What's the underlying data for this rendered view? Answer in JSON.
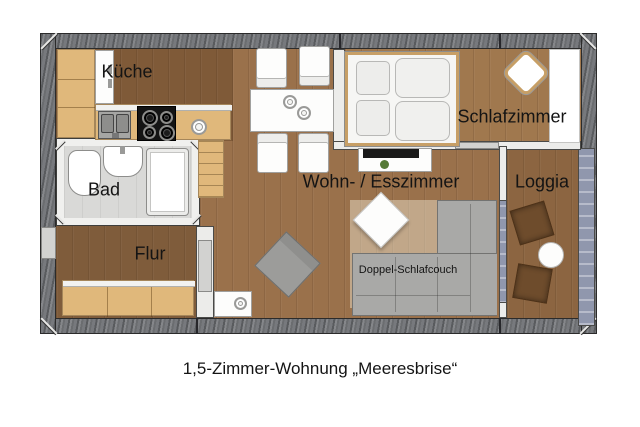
{
  "caption": "1,5-Zimmer-Wohnung „Meeresbrise“",
  "rooms": {
    "kitchen": {
      "label": "Küche"
    },
    "bathroom": {
      "label": "Bad"
    },
    "hallway": {
      "label": "Flur"
    },
    "living": {
      "label": "Wohn- / Esszimmer"
    },
    "bedroom": {
      "label": "Schlafzimmer"
    },
    "loggia": {
      "label": "Loggia"
    }
  },
  "furniture": {
    "sofa_label": "Doppel-Schlafcouch"
  },
  "palette": {
    "exterior_wall": "#77797d",
    "wood_floor_living": "#9a714b",
    "wood_floor_kitchen": "#7f5a38",
    "wood_floor_bedroom": "#a0784e",
    "wood_floor_loggia": "#8c6541",
    "light_wood_furniture": "#e0b87b",
    "bathroom_floor": "#d9d9d7",
    "glass_partition": "#9097ad",
    "sofa_gray": "#a9a9a7",
    "loggia_chair_brown": "#6e4c2c"
  }
}
